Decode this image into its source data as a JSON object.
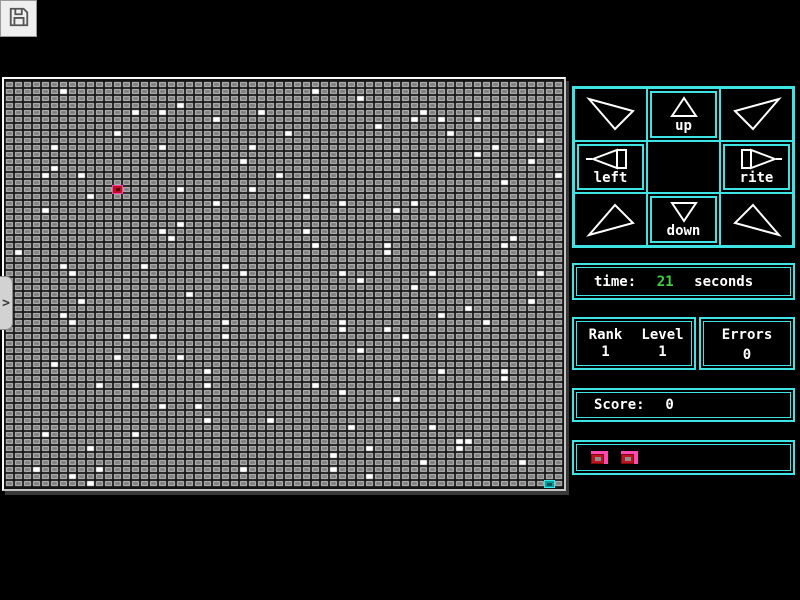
{
  "colors": {
    "accent": "#3fe3e3",
    "time_value": "#3fcf3f",
    "text": "#ffffff",
    "field_gap": "#161616",
    "cell_ring": "#c9c9c9",
    "cell_inner": "#7d7d7d",
    "white_cell": "#ffffff",
    "player_red": "#bc0f20",
    "player_pink": "#ff3fae",
    "goal_teal": "#0a9c9c"
  },
  "toolbar": {
    "save_icon": "floppy-disk-icon"
  },
  "side_handle": {
    "glyph": ">"
  },
  "field": {
    "cols": 62,
    "rows": 58,
    "player": {
      "col": 12,
      "row": 15
    },
    "goal": {
      "col": 60,
      "row": 57
    },
    "white_cells": [
      [
        6,
        1
      ],
      [
        19,
        3
      ],
      [
        14,
        4
      ],
      [
        17,
        4
      ],
      [
        28,
        4
      ],
      [
        23,
        5
      ],
      [
        12,
        7
      ],
      [
        5,
        9
      ],
      [
        17,
        9
      ],
      [
        27,
        9
      ],
      [
        26,
        11
      ],
      [
        5,
        12
      ],
      [
        4,
        13
      ],
      [
        8,
        13
      ],
      [
        30,
        13
      ],
      [
        61,
        13
      ],
      [
        19,
        15
      ],
      [
        27,
        15
      ],
      [
        9,
        16
      ],
      [
        23,
        17
      ],
      [
        4,
        18
      ],
      [
        19,
        20
      ],
      [
        17,
        21
      ],
      [
        18,
        22
      ],
      [
        1,
        24
      ],
      [
        6,
        26
      ],
      [
        15,
        26
      ],
      [
        24,
        26
      ],
      [
        7,
        27
      ],
      [
        26,
        27
      ],
      [
        34,
        1
      ],
      [
        39,
        2
      ],
      [
        46,
        4
      ],
      [
        45,
        5
      ],
      [
        48,
        5
      ],
      [
        52,
        5
      ],
      [
        41,
        6
      ],
      [
        31,
        7
      ],
      [
        49,
        7
      ],
      [
        59,
        8
      ],
      [
        54,
        9
      ],
      [
        52,
        10
      ],
      [
        58,
        11
      ],
      [
        55,
        14
      ],
      [
        33,
        16
      ],
      [
        37,
        17
      ],
      [
        45,
        17
      ],
      [
        43,
        18
      ],
      [
        33,
        21
      ],
      [
        56,
        22
      ],
      [
        34,
        23
      ],
      [
        42,
        23
      ],
      [
        55,
        23
      ],
      [
        42,
        24
      ],
      [
        37,
        27
      ],
      [
        47,
        27
      ],
      [
        59,
        27
      ],
      [
        39,
        28
      ],
      [
        45,
        29
      ],
      [
        20,
        30
      ],
      [
        8,
        31
      ],
      [
        6,
        33
      ],
      [
        7,
        34
      ],
      [
        24,
        34
      ],
      [
        13,
        36
      ],
      [
        16,
        36
      ],
      [
        24,
        36
      ],
      [
        12,
        39
      ],
      [
        19,
        39
      ],
      [
        5,
        40
      ],
      [
        22,
        41
      ],
      [
        10,
        43
      ],
      [
        14,
        43
      ],
      [
        22,
        43
      ],
      [
        17,
        46
      ],
      [
        21,
        46
      ],
      [
        22,
        48
      ],
      [
        29,
        48
      ],
      [
        4,
        50
      ],
      [
        14,
        50
      ],
      [
        9,
        52
      ],
      [
        3,
        55
      ],
      [
        10,
        55
      ],
      [
        26,
        55
      ],
      [
        7,
        56
      ],
      [
        9,
        57
      ],
      [
        58,
        31
      ],
      [
        51,
        32
      ],
      [
        48,
        33
      ],
      [
        37,
        34
      ],
      [
        53,
        34
      ],
      [
        37,
        35
      ],
      [
        42,
        35
      ],
      [
        44,
        36
      ],
      [
        39,
        38
      ],
      [
        48,
        41
      ],
      [
        55,
        41
      ],
      [
        55,
        42
      ],
      [
        34,
        43
      ],
      [
        37,
        44
      ],
      [
        43,
        45
      ],
      [
        38,
        49
      ],
      [
        47,
        49
      ],
      [
        50,
        51
      ],
      [
        51,
        51
      ],
      [
        40,
        52
      ],
      [
        50,
        52
      ],
      [
        36,
        53
      ],
      [
        46,
        54
      ],
      [
        57,
        54
      ],
      [
        36,
        55
      ],
      [
        40,
        56
      ]
    ]
  },
  "dpad": {
    "cells": [
      {
        "id": "up-left",
        "glyph": "triangle-up-left",
        "label": "",
        "framed": false
      },
      {
        "id": "up",
        "glyph": "triangle-up",
        "label": "up",
        "framed": true
      },
      {
        "id": "up-right",
        "glyph": "triangle-up-right",
        "label": "",
        "framed": false
      },
      {
        "id": "left",
        "glyph": "triangle-left",
        "label": "left",
        "framed": true
      },
      {
        "id": "center",
        "glyph": "",
        "label": "",
        "framed": false
      },
      {
        "id": "rite",
        "glyph": "triangle-right",
        "label": "rite",
        "framed": true
      },
      {
        "id": "down-left",
        "glyph": "triangle-down-left",
        "label": "",
        "framed": false
      },
      {
        "id": "down",
        "glyph": "triangle-down",
        "label": "down",
        "framed": true
      },
      {
        "id": "down-right",
        "glyph": "triangle-down-right",
        "label": "",
        "framed": false
      }
    ]
  },
  "time_panel": {
    "label": "time:",
    "value": "21",
    "unit": "seconds"
  },
  "stats_panel": {
    "rank_label": "Rank",
    "rank_value": "1",
    "level_label": "Level",
    "level_value": "1",
    "errors_label": "Errors",
    "errors_value": "0"
  },
  "score_panel": {
    "label": "Score:",
    "value": "0"
  },
  "lives_panel": {
    "count": 2
  }
}
